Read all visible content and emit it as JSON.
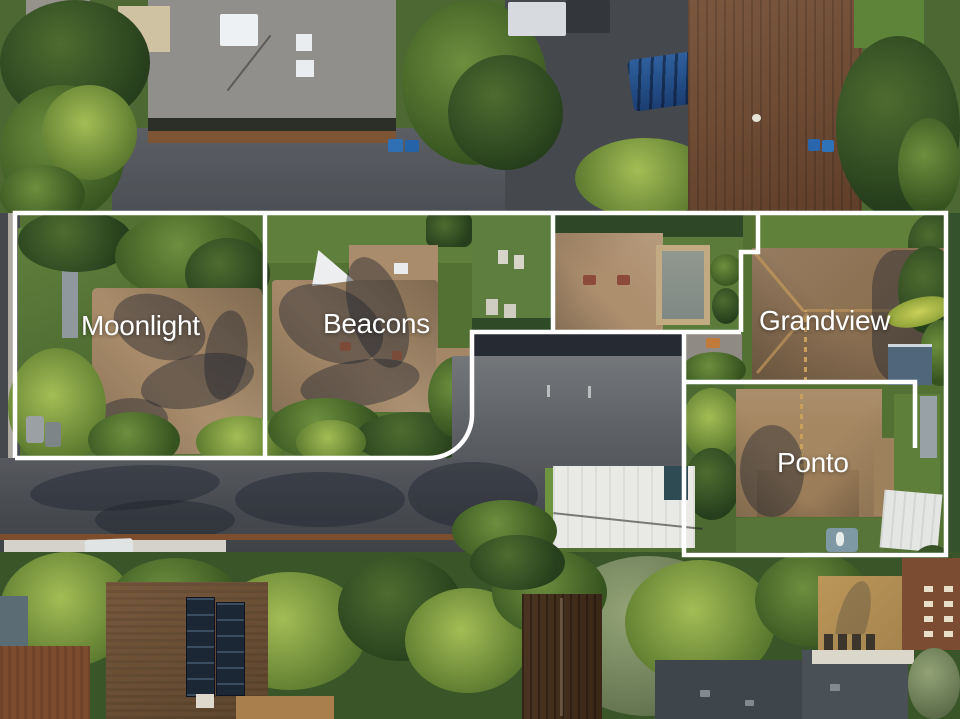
{
  "scene": {
    "type": "aerial-parcel-overlay",
    "boundary_color": "#ffffff"
  },
  "parcels": [
    {
      "name": "Moonlight"
    },
    {
      "name": "Beacons"
    },
    {
      "name": "Grandview"
    },
    {
      "name": "Ponto"
    }
  ]
}
